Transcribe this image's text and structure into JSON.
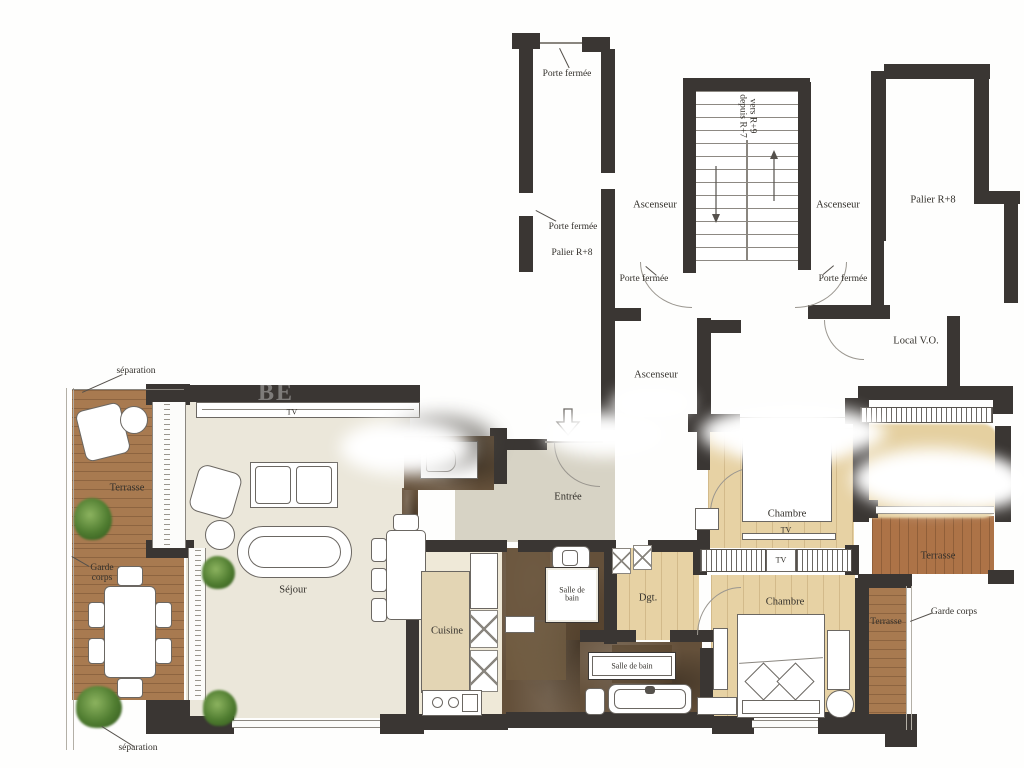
{
  "labels": {
    "porte_fermee_top": "Porte fermée",
    "porte_fermee_palier": "Porte fermée",
    "palier_left": "Palier R+8",
    "ascenseur_top": "Ascenseur",
    "stairs_note_1": "vers R+9",
    "stairs_note_2": "depuis R+7",
    "ascenseur_right": "Ascenseur",
    "palier_right": "Palier R+8",
    "porte_fermee_corridor_left": "Porte fermée",
    "porte_fermee_corridor_right": "Porte fermée",
    "ascenseur_lower": "Ascenseur",
    "local_vo": "Local V.O.",
    "separation_top": "séparation",
    "separation_bottom": "séparation",
    "terrasse_left": "Terrasse",
    "garde_corps_left": "Garde corps",
    "garde_corps_right": "Garde corps",
    "sejour": "Séjour",
    "tv_sejour": "TV",
    "tv_chambre": "TV",
    "tv_wardrobe": "TV",
    "entree": "Entrée",
    "cuisine": "Cuisine",
    "salle_de_bain_1": "Salle de bain",
    "salle_de_bain_2": "Salle de bain",
    "dgt": "Dgt.",
    "chambre_1": "Chambre",
    "chambre_2": "Chambre",
    "terrasse_right_top": "Terrasse",
    "terrasse_right_side": "Terrasse",
    "watermark": "BE"
  },
  "colors": {
    "wall": "#3a3633",
    "wood_deck": "#a87a50",
    "parquet": "#e7d2a4",
    "marble": "#64503a",
    "living_floor": "#ebe7da",
    "entry_floor": "#d7d3c5"
  }
}
